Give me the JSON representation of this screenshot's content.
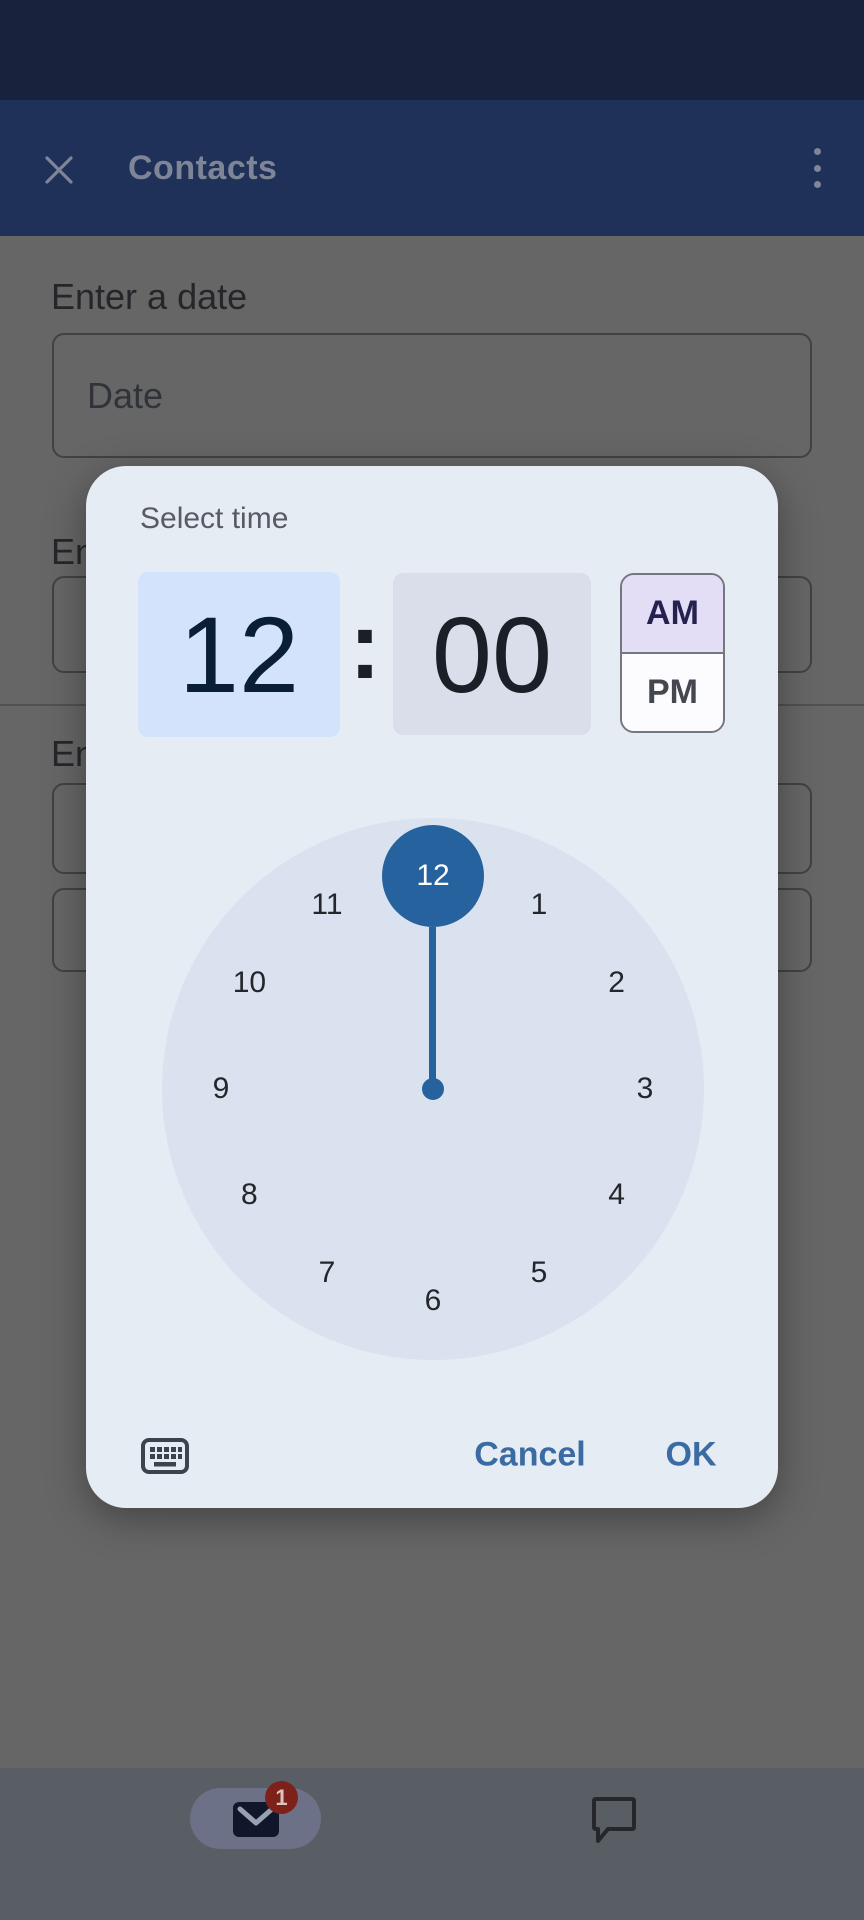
{
  "app_bar": {
    "title": "Contacts"
  },
  "form": {
    "date_label": "Enter a date",
    "date_placeholder": "Date",
    "truncated_label_top": "En",
    "truncated_label_bottom": "En"
  },
  "time_picker": {
    "title": "Select time",
    "hour": "12",
    "minute": "00",
    "colon": ":",
    "period_am": "AM",
    "period_pm": "PM",
    "selected_period": "AM",
    "selected_hour": "12",
    "clock_numbers": [
      "12",
      "1",
      "2",
      "3",
      "4",
      "5",
      "6",
      "7",
      "8",
      "9",
      "10",
      "11"
    ],
    "cancel_label": "Cancel",
    "ok_label": "OK"
  },
  "bottom_nav": {
    "mail_badge_count": "1"
  },
  "colors": {
    "dialog_surface": "#e6ecf4",
    "hour_selected_bg": "#d3e3fb",
    "minute_bg": "#d9deea",
    "am_selected_bg": "#e3ddf6",
    "clock_face": "#dbe2ef",
    "selection_blue": "#26639e",
    "action_blue": "#3a6ba3",
    "app_bar_bg": "#1f3158",
    "status_bar_bg": "#19223c",
    "badge_red": "#7f211b",
    "nav_bar_bg": "#585e64"
  }
}
